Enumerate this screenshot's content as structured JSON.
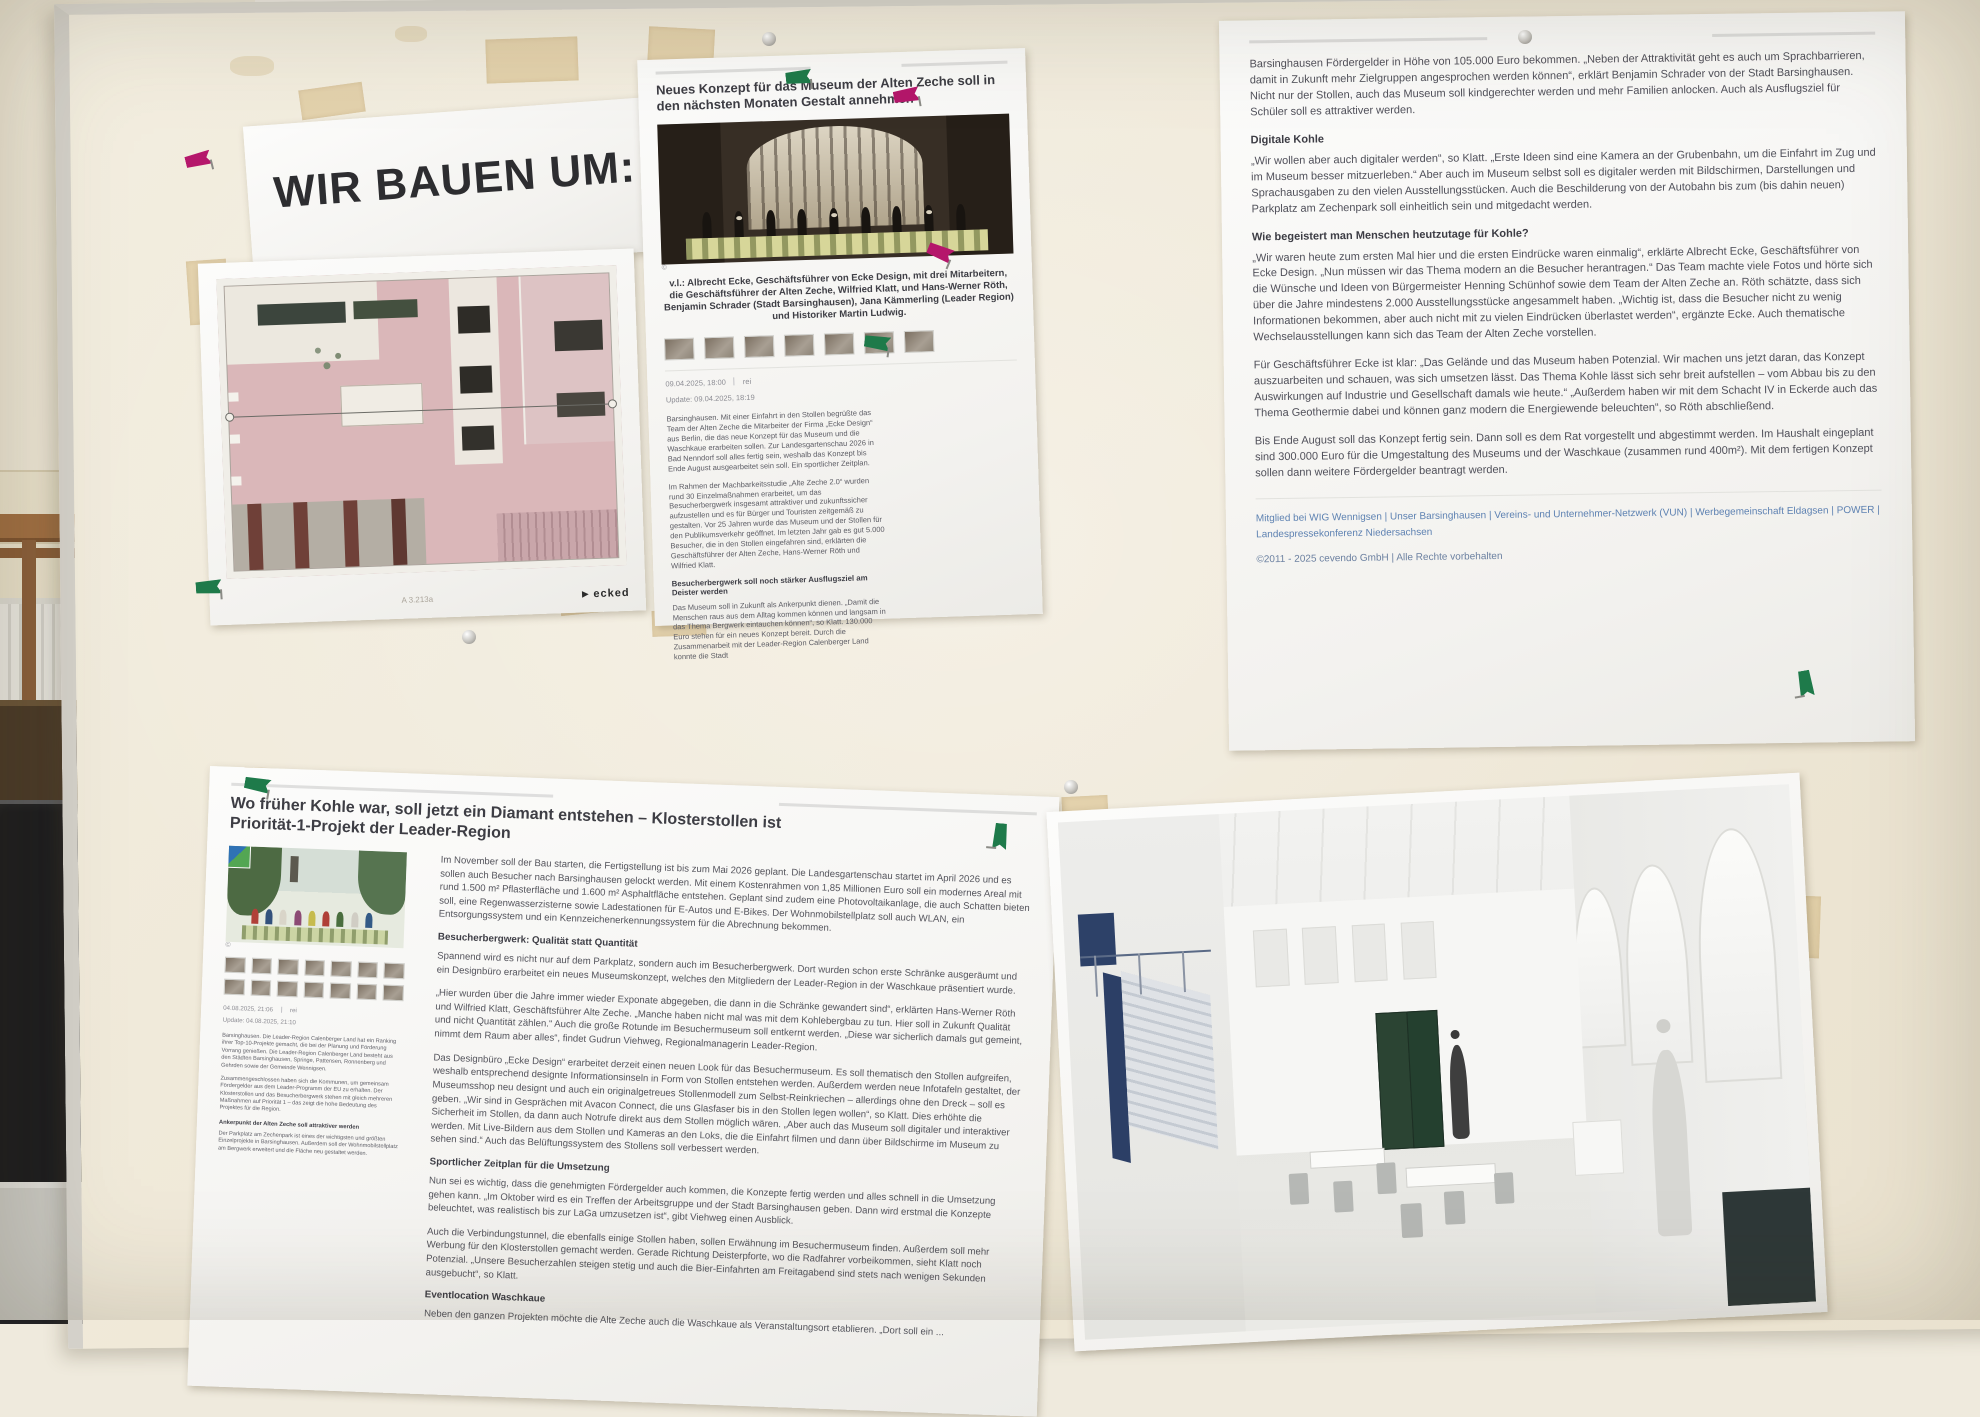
{
  "colors": {
    "link_blue": "#5e82b2",
    "pin_green": "#1e7a4a",
    "pin_magenta": "#b5176b",
    "tape_beige": "#d7bc83",
    "board_surface": "#efe8d7",
    "plan_floor_pink": "#dab7b9"
  },
  "title_card": {
    "text": "WIR BAUEN UM:"
  },
  "floorplan": {
    "logo_triangle": "▶",
    "logo_text": "ecked",
    "plan_label": "A 3.213a"
  },
  "article_museum": {
    "headline": "Neues Konzept für das Museum der Alten Zeche soll in den nächsten Monaten Gestalt annehmen",
    "copyright_mark": "©",
    "caption": "v.l.: Albrecht Ecke, Geschäftsführer von Ecke Design, mit drei Mitarbeitern, die Geschäftsführer der Alten Zeche, Wilfried Klatt, und Hans-Werner Röth, Benjamin Schrader (Stadt Barsinghausen), Jana Kämmerling (Leader Region) und Historiker Martin Ludwig.",
    "date": "09.04.2025, 18:00",
    "source": "rei",
    "update_line": "Update: 09.04.2025, 18:19",
    "body": [
      "Barsinghausen. Mit einer Einfahrt in den Stollen begrüßte das Team der Alten Zeche die Mitarbeiter der Firma „Ecke Design“ aus Berlin, die das neue Konzept für das Museum und die Waschkaue erarbeiten sollen. Zur Landesgartenschau 2026 in Bad Nenndorf soll alles fertig sein, weshalb das Konzept bis Ende August ausgearbeitet sein soll. Ein sportlicher Zeitplan.",
      "Im Rahmen der Machbarkeitsstudie „Alte Zeche 2.0“ wurden rund 30 Einzelmaßnahmen erarbeitet, um das Besucherbergwerk insgesamt attraktiver und zukunftssicher aufzustellen und es für Bürger und Touristen zeitgemäß zu gestalten. Vor 25 Jahren wurde das Museum und der Stollen für den Publikumsverkehr geöffnet. Im letzten Jahr gab es gut 5.000 Besucher, die in den Stollen eingefahren sind, erklärten die Geschäftsführer der Alten Zeche, Hans-Werner Röth und Wilfried Klatt."
    ],
    "subhead": "Besucherbergwerk soll noch stärker Ausflugsziel am Deister werden",
    "body2": [
      "Das Museum soll in Zukunft als Ankerpunkt dienen. „Damit die Menschen raus aus dem Alltag kommen können und langsam in das Thema Bergwerk eintauchen können“, so Klatt. 130.000 Euro stehen für ein neues Konzept bereit. Durch die Zusammenarbeit mit der Leader-Region Calenberger Land konnte die Stadt"
    ]
  },
  "article_museum_cont": {
    "p_intro": "Barsinghausen Fördergelder in Höhe von 105.000 Euro bekommen. „Neben der Attraktivität geht es auch um Sprachbarrieren, damit in Zukunft mehr Zielgruppen angesprochen werden können“, erklärt Benjamin Schrader von der Stadt Barsinghausen. Nicht nur der Stollen, auch das Museum soll kindgerechter werden und mehr Familien anlocken. Auch als Ausflugsziel für Schüler soll es attraktiver werden.",
    "subhead_digital": "Digitale Kohle",
    "p_digital": "„Wir wollen aber auch digitaler werden“, so Klatt. „Erste Ideen sind eine Kamera an der Grubenbahn, um die Einfahrt im Zug und im Museum besser mitzuerleben.“ Aber auch im Museum selbst soll es digitaler werden mit Bildschirmen, Darstellungen und Sprachausgaben zu den vielen Ausstellungsstücken. Auch die Beschilderung von der Autobahn bis zum (bis dahin neuen) Parkplatz am Zechenpark soll einheitlich sein und mitgedacht werden.",
    "subhead_begeistert": "Wie begeistert man Menschen heutzutage für Kohle?",
    "p_begeistert": "„Wir waren heute zum ersten Mal hier und die ersten Eindrücke waren einmalig“, erklärte Albrecht Ecke, Geschäftsführer von Ecke Design. „Nun müssen wir das Thema modern an die Besucher herantragen.“ Das Team machte viele Fotos und hörte sich die Wünsche und Ideen von Bürgermeister Henning Schünhof sowie dem Team der Alten Zeche an. Röth schätzte, dass sich über die Jahre mindestens 2.000 Ausstellungsstücke angesammelt haben. „Wichtig ist, dass die Besucher nicht zu wenig Informationen bekommen, aber auch nicht mit zu vielen Eindrücken überlastet werden“, ergänzte Ecke. Auch thematische Wechselausstellungen kann sich das Team der Alten Zeche vorstellen.",
    "p_potenzial": "Für Geschäftsführer Ecke ist klar: „Das Gelände und das Museum haben Potenzial. Wir machen uns jetzt daran, das Konzept auszuarbeiten und schauen, was sich umsetzen lässt. Das Thema Kohle lässt sich sehr breit aufstellen – vom Abbau bis zu den Auswirkungen auf Industrie und Gesellschaft damals wie heute.“ „Außerdem haben wir mit dem Schacht IV in Eckerde auch das Thema Geothermie dabei und können ganz modern die Energiewende beleuchten“, so Röth abschließend.",
    "p_final": "Bis Ende August soll das Konzept fertig sein. Dann soll es dem Rat vorgestellt und abgestimmt werden. Im Haushalt eingeplant sind 300.000 Euro für die Umgestaltung des Museums und der Waschkaue (zusammen rund 400m²). Mit dem fertigen Konzept sollen dann weitere Fördergelder beantragt werden.",
    "links": "Mitglied bei WIG Wennigsen  |  Unser Barsinghausen  |  Vereins- und Unternehmer-Netzwerk (VUN)  |  Werbegemeinschaft Eldagsen  |  POWER  |  Landespressekonferenz Niedersachsen",
    "copyright": "©2011 - 2025 cevendo GmbH | Alle Rechte vorbehalten"
  },
  "article_klosterstollen": {
    "headline": "Wo früher Kohle war, soll jetzt ein Diamant entstehen – Klosterstollen ist Priorität-1-Projekt der Leader-Region",
    "copyright_mark": "©",
    "date": "04.08.2025, 21:06",
    "source": "rei",
    "update_line": "Update: 04.08.2025, 21:10",
    "left": {
      "p1": "Barsinghausen. Die Leader-Region Calenberger Land hat ein Ranking ihrer Top-10-Projekte gemacht, die bei der Planung und Förderung Vorrang genießen. Die Leader-Region Calenberger Land besteht aus den Städten Barsinghausen, Springe, Pattensen, Ronnenberg und Gehrden sowie der Gemeinde Wennigsen.",
      "p2": "Zusammengeschlossen haben sich die Kommunen, um gemeinsam Fördergelder aus dem Leader-Programm der EU zu erhalten. Der Klosterstollen und das Besucherbergwerk stehen mit gleich mehreren Maßnahmen auf Priorität 1 – das zeigt die hohe Bedeutung des Projektes für die Region.",
      "subhead": "Ankerpunkt der Alten Zeche soll attraktiver werden",
      "p3": "Der Parkplatz am Zechenpark ist eines der wichtigsten und größten Einzelprojekte in Barsinghausen. Außerdem soll der Wohnmobilstellplatz am Bergwerk erweitert und die Fläche neu gestaltet werden."
    },
    "main": {
      "p1": "Im November soll der Bau starten, die Fertigstellung ist bis zum Mai 2026 geplant. Die Landesgartenschau startet im April 2026 und es sollen auch Besucher nach Barsinghausen gelockt werden. Mit einem Kostenrahmen von 1,85 Millionen Euro soll ein modernes Areal mit rund 1.500 m² Pflasterfläche und 1.600 m² Asphaltfläche entstehen. Geplant sind zudem eine Photovoltaikanlage, die auch Schatten bieten soll, eine Regenwasserzisterne sowie Ladestationen für E-Autos und E-Bikes. Der Wohnmobilstellplatz soll auch WLAN, ein Entsorgungssystem und ein Kennzeichenerkennungssystem für die Abrechnung bekommen.",
      "sub1": "Besucherbergwerk: Qualität statt Quantität",
      "p2": "Spannend wird es nicht nur auf dem Parkplatz, sondern auch im Besucherbergwerk. Dort wurden schon erste Schränke ausgeräumt und ein Designbüro erarbeitet ein neues Museumskonzept, welches den Mitgliedern der Leader-Region in der Waschkaue präsentiert wurde.",
      "p3": "„Hier wurden über die Jahre immer wieder Exponate abgegeben, die dann in die Schränke gewandert sind“, erklärten Hans-Werner Röth und Wilfried Klatt, Geschäftsführer Alte Zeche. „Manche haben nicht mal was mit dem Kohlebergbau zu tun. Hier soll in Zukunft Qualität und nicht Quantität zählen.“ Auch die große Rotunde im Besuchermuseum soll entkernt werden. „Diese war sicherlich damals gut gemeint, nimmt dem Raum aber alles“, findet Gudrun Viehweg, Regionalmanagerin Leader-Region.",
      "p4": "Das Designbüro „Ecke Design“ erarbeitet derzeit einen neuen Look für das Besuchermuseum. Es soll thematisch den Stollen aufgreifen, weshalb entsprechend designte Informationsinseln in Form von Stollen entstehen werden. Außerdem werden neue Infotafeln gestaltet, der Museumsshop neu designt und auch ein originalgetreues Stollenmodell zum Selbst-Reinkriechen – allerdings ohne den Dreck – soll es geben. „Wir sind in Gesprächen mit Avacon Connect, die uns Glasfaser bis in den Stollen legen wollen“, so Klatt. Dies erhöhte die Sicherheit im Stollen, da dann auch Notrufe direkt aus dem Stollen möglich wären. „Aber auch das Museum soll digitaler und interaktiver werden. Mit Live-Bildern aus dem Stollen und Kameras an den Loks, die die Einfahrt filmen und dann über Bildschirme im Museum zu sehen sind.“ Auch das Belüftungssystem des Stollens soll verbessert werden.",
      "sub2": "Sportlicher Zeitplan für die Umsetzung",
      "p5": "Nun sei es wichtig, dass die genehmigten Fördergelder auch kommen, die Konzepte fertig werden und alles schnell in die Umsetzung gehen kann. „Im Oktober wird es ein Treffen der Arbeitsgruppe und der Stadt Barsinghausen geben. Dann wird erstmal die Konzepte beleuchtet, was realistisch bis zur LaGa umzusetzen ist“, gibt Viehweg einen Ausblick.",
      "p6": "Auch die Verbindungstunnel, die ebenfalls einige Stollen haben, sollen Erwähnung im Besuchermuseum finden. Außerdem soll mehr Werbung für den Klosterstollen gemacht werden. Gerade Richtung Deisterpforte, wo die Radfahrer vorbeikommen, sieht Klatt noch Potenzial. „Unsere Besucherzahlen steigen stetig und auch die Bier-Einfahrten am Freitagabend sind stets nach wenigen Sekunden ausgebucht“, so Klatt.",
      "sub3": "Eventlocation Waschkaue",
      "p7": "Neben den ganzen Projekten möchte die Alte Zeche auch die Waschkaue als Veranstaltungsort etablieren. „Dort soll ein ..."
    }
  }
}
